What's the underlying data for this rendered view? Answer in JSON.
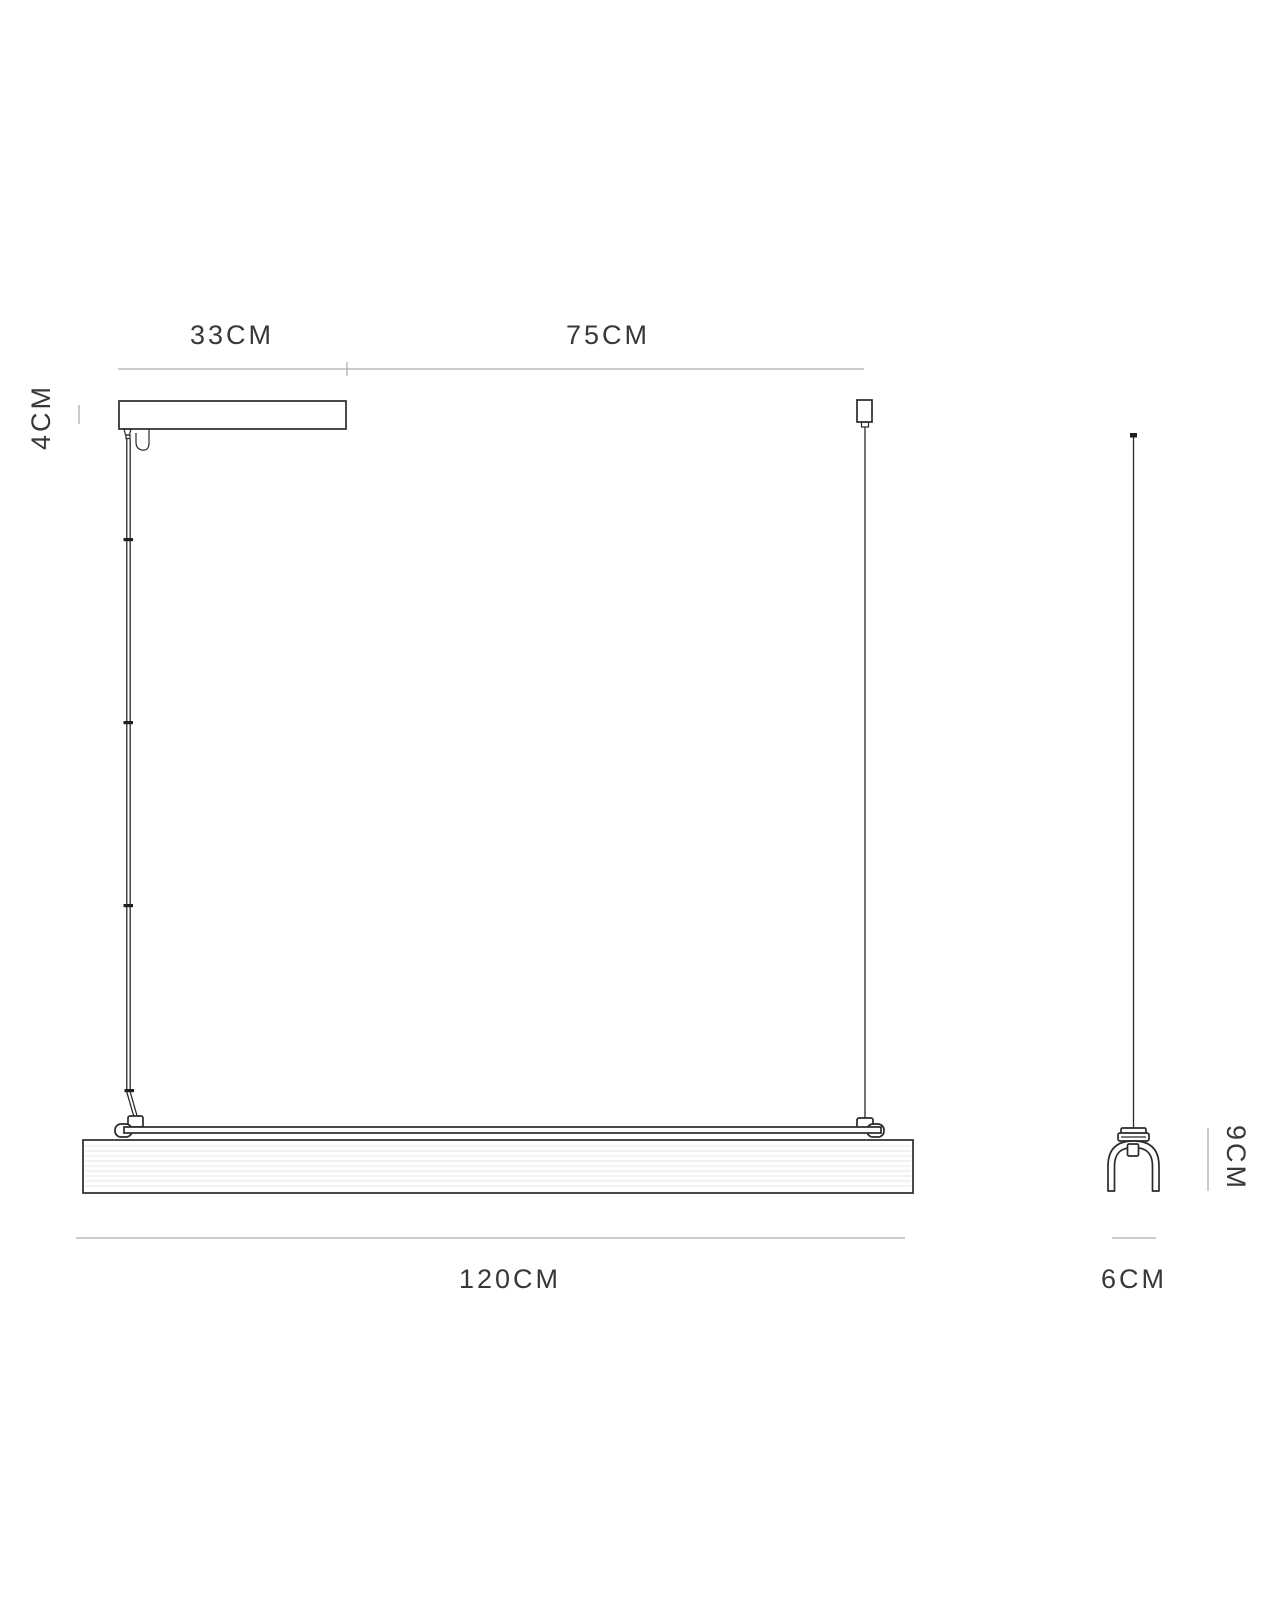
{
  "diagram": {
    "type": "technical-dimension-drawing",
    "subject": "linear suspension pendant light fixture, front and side views",
    "front": {
      "canopy_width_label": "33CM",
      "drop_span_label": "75CM",
      "canopy_height_label": "4CM",
      "fixture_length_label": "120CM"
    },
    "side": {
      "fixture_height_label": "9CM",
      "fixture_depth_label": "6CM"
    },
    "colors": {
      "outline": "#2a2a2a",
      "dimension_line": "#adadad",
      "label_text": "#383838",
      "hatch_line": "#e4e4e4",
      "background": "#ffffff"
    }
  }
}
